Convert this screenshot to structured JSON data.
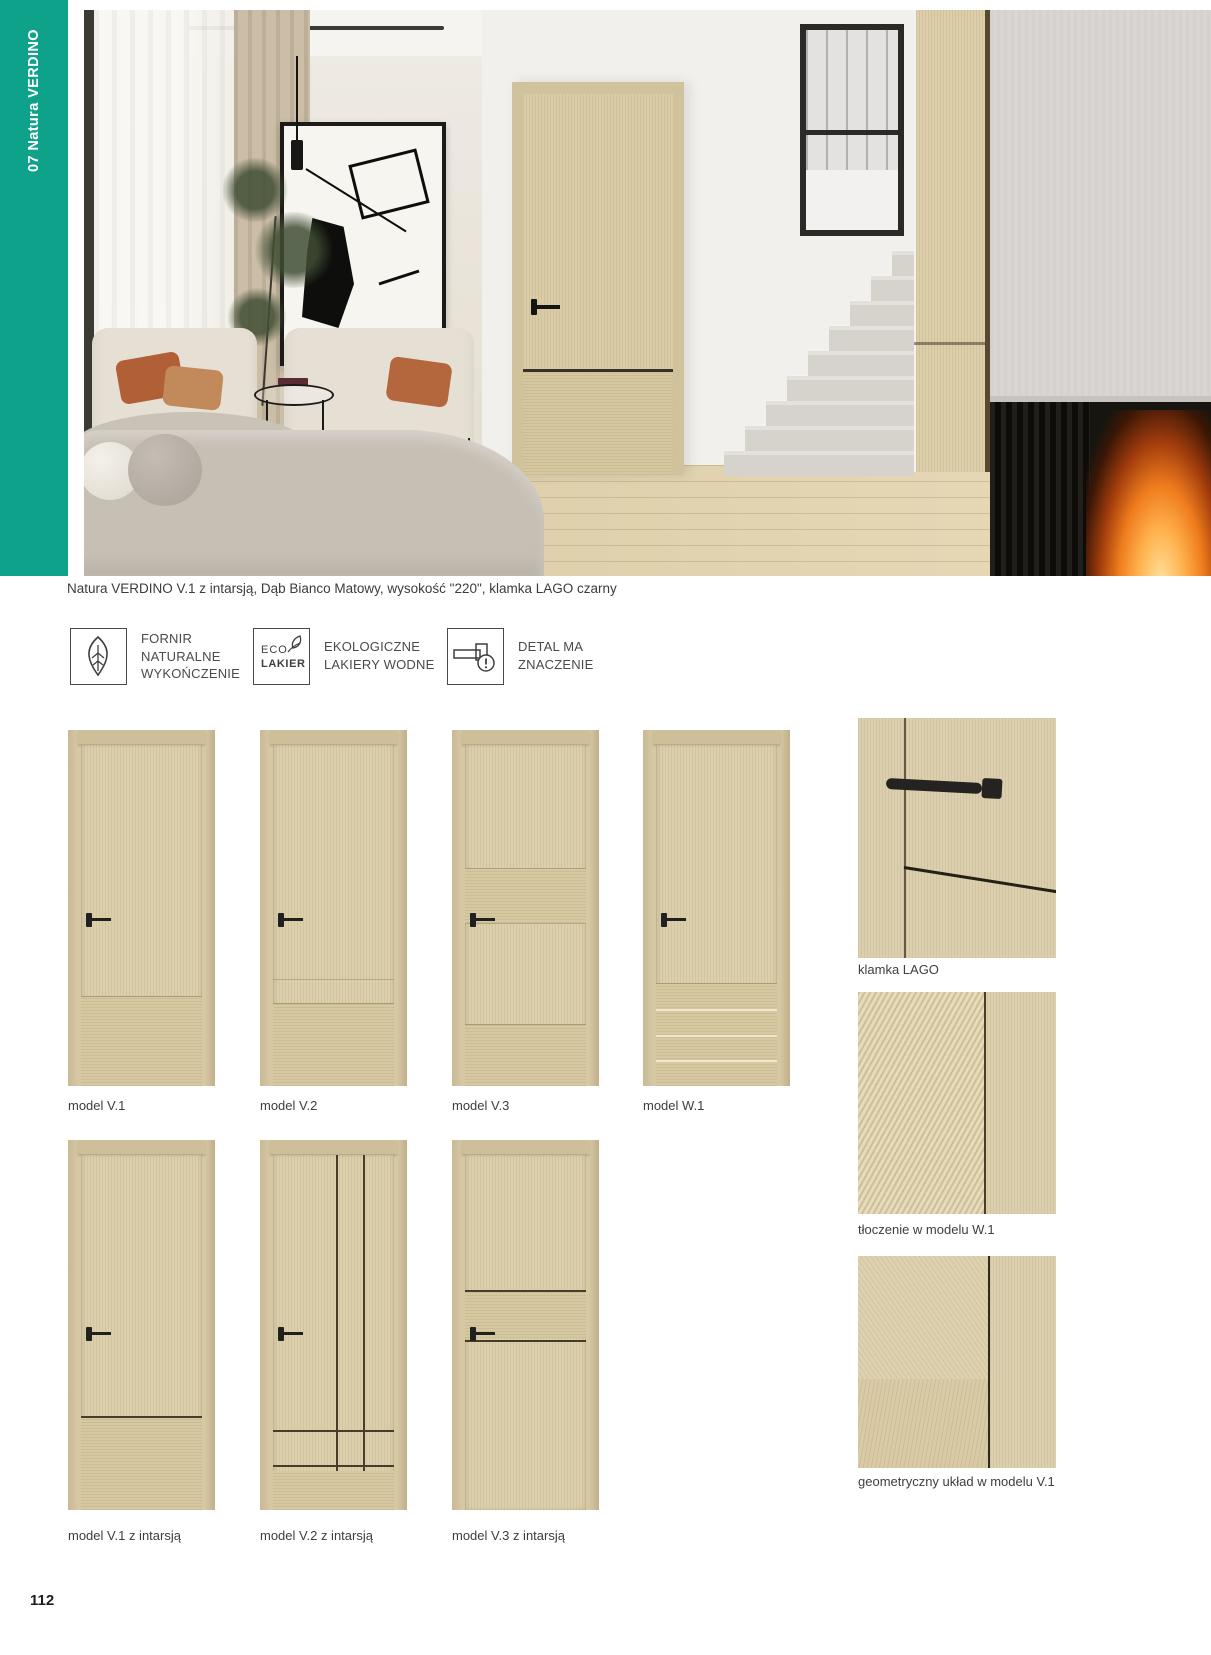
{
  "accent_color": "#0fa28b",
  "sidebar": {
    "label": "07  Natura VERDINO"
  },
  "hero": {
    "caption": "Natura VERDINO V.1  z intarsją, Dąb Bianco Matowy, wysokość \"220\", klamka LAGO czarny"
  },
  "features": [
    {
      "icon": "leaf-icon",
      "lines": [
        "FORNIR",
        "NATURALNE",
        "WYKOŃCZENIE"
      ]
    },
    {
      "icon": "eco-lakier-icon",
      "badge": {
        "top": "ECO",
        "bottom": "LAKIER"
      },
      "lines": [
        "EKOLOGICZNE",
        "LAKIERY WODNE"
      ]
    },
    {
      "icon": "door-handle-detail-icon",
      "lines": [
        "DETAL MA",
        "ZNACZENIE"
      ]
    }
  ],
  "models_row1": [
    {
      "label": "model V.1"
    },
    {
      "label": "model V.2"
    },
    {
      "label": "model V.3"
    },
    {
      "label": "model W.1"
    }
  ],
  "models_row2": [
    {
      "label": "model V.1 z intarsją"
    },
    {
      "label": "model V.2 z intarsją"
    },
    {
      "label": "model V.3 z intarsją"
    }
  ],
  "details": [
    {
      "label": "klamka LAGO"
    },
    {
      "label": "tłoczenie w modelu W.1"
    },
    {
      "label": "geometryczny układ w modelu V.1"
    }
  ],
  "page": {
    "number": "112"
  }
}
